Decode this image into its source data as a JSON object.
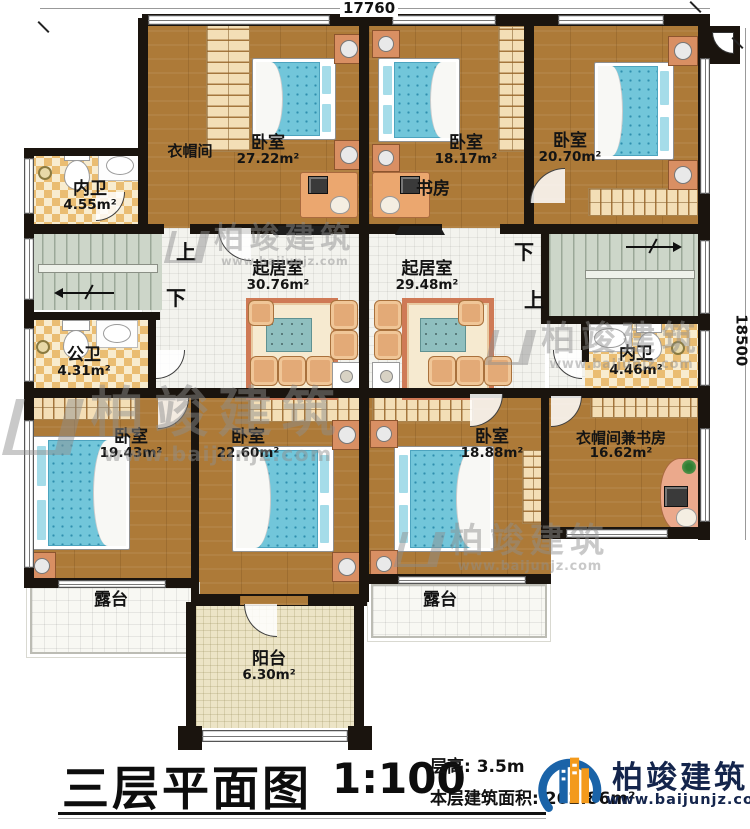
{
  "plan": {
    "dimensions": {
      "width": "17760",
      "height": "18500"
    },
    "stairs": {
      "up": "上",
      "down": "下"
    },
    "rooms": {
      "neiwei_tl": {
        "name": "内卫",
        "area": "4.55m²"
      },
      "yimaojian": {
        "name": "衣帽间"
      },
      "bedroom_27": {
        "name": "卧室",
        "area": "27.22m²"
      },
      "bedroom_18_17": {
        "name": "卧室",
        "area": "18.17m²"
      },
      "shufang": {
        "name": "书房"
      },
      "bedroom_20_70": {
        "name": "卧室",
        "area": "20.70m²"
      },
      "living_left": {
        "name": "起居室",
        "area": "30.76m²"
      },
      "living_right": {
        "name": "起居室",
        "area": "29.48m²"
      },
      "gongwei": {
        "name": "公卫",
        "area": "4.31m²"
      },
      "neiwei_r": {
        "name": "内卫",
        "area": "4.46m²"
      },
      "bedroom_19_43": {
        "name": "卧室",
        "area": "19.43m²"
      },
      "bedroom_22_60": {
        "name": "卧室",
        "area": "22.60m²"
      },
      "bedroom_18_88": {
        "name": "卧室",
        "area": "18.88m²"
      },
      "cloak_study": {
        "name": "衣帽间兼书房",
        "area": "16.62m²"
      },
      "terrace_left": {
        "name": "露台"
      },
      "terrace_right": {
        "name": "露台"
      },
      "balcony": {
        "name": "阳台",
        "area": "6.30m²"
      }
    }
  },
  "titleblock": {
    "title": "三层平面图",
    "scale": "1:100",
    "floor_height": "层高: 3.5m",
    "floor_area": "本层建筑面积: 262.86m²"
  },
  "brand": {
    "name": "柏竣建筑",
    "url": "www.baijunjz.com",
    "accent_blue": "#1a63a8",
    "accent_orange": "#f39a1c"
  }
}
